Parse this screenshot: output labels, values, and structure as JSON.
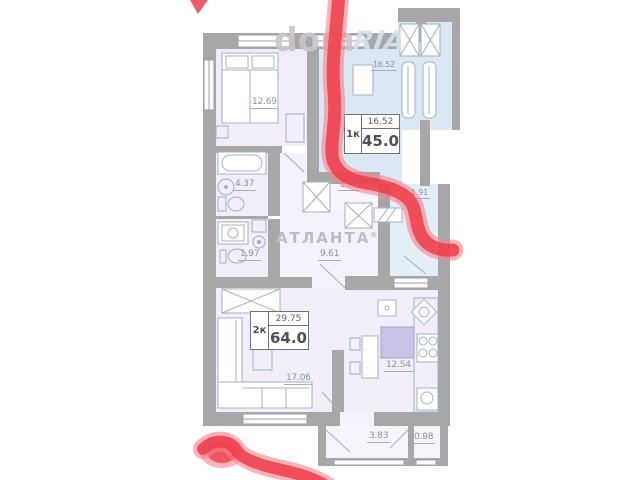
{
  "watermarks": {
    "dom": "dom",
    "ria": "RIA",
    "brand": "АТЛАНТА",
    "reg": "®"
  },
  "apartments": [
    {
      "label": "1к",
      "living_area": "16.52",
      "total_area": "45.0"
    },
    {
      "label": "2к",
      "living_area": "29.75",
      "total_area": "64.0"
    }
  ],
  "rooms": [
    {
      "name": "bedroom",
      "area": "12.69"
    },
    {
      "name": "room-1k",
      "area": "16.52"
    },
    {
      "name": "bathroom",
      "area": "4.37"
    },
    {
      "name": "wc",
      "area": "1.97"
    },
    {
      "name": "hallway",
      "area": "9.61"
    },
    {
      "name": "hall-1k",
      "area": "1.77"
    },
    {
      "name": "entry-1k",
      "area": "1.91"
    },
    {
      "name": "living-room",
      "area": "17.06"
    },
    {
      "name": "kitchen",
      "area": "12.54"
    },
    {
      "name": "balcony",
      "area": "3.83"
    },
    {
      "name": "balcony-small",
      "area": "0.98"
    }
  ],
  "colors": {
    "wall": "#a7a7a9",
    "fill_apartment_2k": "#f1eef9",
    "fill_apartment_1k": "#dbe8f4",
    "marker_red": "#ee3c4a",
    "kitchen_island": "#c9c3e8"
  }
}
